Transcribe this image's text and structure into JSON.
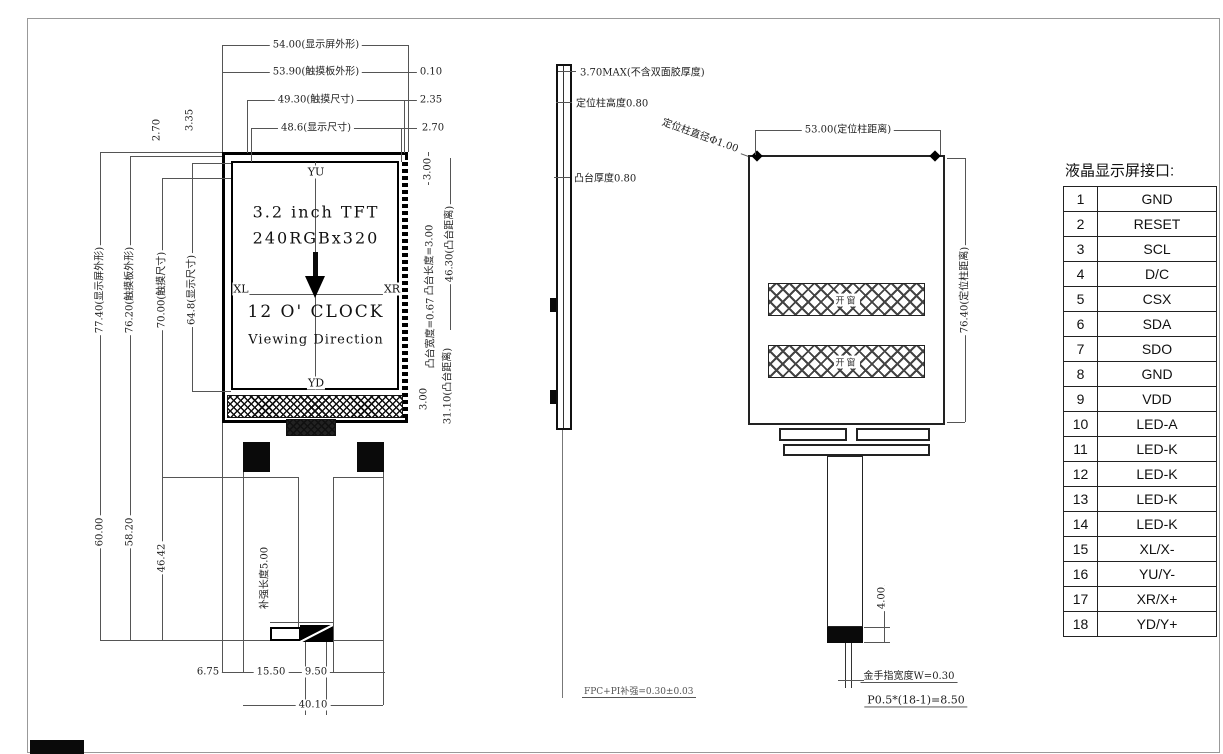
{
  "front_view": {
    "size_label_1": "3.2 inch TFT",
    "size_label_2": "240RGBx320",
    "clock": "12 O' CLOCK",
    "viewing": "Viewing Direction",
    "marker_top": "YU",
    "marker_bottom": "YD",
    "marker_left": "XL",
    "marker_right": "XR",
    "dim_top_1": "54.00(显示屏外形)",
    "dim_top_2": "53.90(触摸板外形)",
    "dim_top_3": "49.30(触摸尺寸)",
    "dim_top_4": "48.6(显示尺寸)",
    "dim_top_right_1": "0.10",
    "dim_top_right_2": "2.35",
    "dim_top_right_3": "2.70",
    "dim_left_1": "77.40(显示屏外形)",
    "dim_left_2": "76.20(触摸板外形)",
    "dim_left_3": "70.00(触摸尺寸)",
    "dim_left_4": "64.8(显示尺寸)",
    "dim_left_small_1": "2.70",
    "dim_left_small_2": "3.35",
    "dim_right_1": "3.00",
    "dim_right_2": "凸台长度=3.00",
    "dim_right_3": "46.30(凸台距离)",
    "dim_right_4": "凸台宽度=0.67",
    "dim_right_5": "3.00",
    "dim_right_6": "31.10(凸台距离)",
    "dim_bottom_left_1": "60.00",
    "dim_bottom_left_2": "58.20",
    "dim_bottom_left_3": "46.42",
    "stiffener": "补强长度5.00",
    "dim_bottom_1": "6.75",
    "dim_bottom_2": "15.50",
    "dim_bottom_3": "9.50",
    "dim_bottom_4": "40.10"
  },
  "side_view": {
    "label_thickness": "3.70MAX(不含双面胶厚度)",
    "label_post_height": "定位柱高度0.80",
    "label_boss_thickness": "凸台厚度0.80",
    "label_post_diameter": "定位柱直径Φ1.00",
    "label_fpc": "FPC+PI补强=0.30±0.03"
  },
  "back_view": {
    "dim_top": "53.00(定位柱距离)",
    "dim_right": "76.40(定位柱距离)",
    "window": "开窗",
    "dim_tail": "4.00",
    "note_finger": "金手指宽度W=0.30",
    "note_pitch": "P0.5*(18-1)=8.50"
  },
  "pin_table": {
    "title": "液晶显示屏接口:",
    "rows": [
      {
        "no": "1",
        "name": "GND"
      },
      {
        "no": "2",
        "name": "RESET"
      },
      {
        "no": "3",
        "name": "SCL"
      },
      {
        "no": "4",
        "name": "D/C"
      },
      {
        "no": "5",
        "name": "CSX"
      },
      {
        "no": "6",
        "name": "SDA"
      },
      {
        "no": "7",
        "name": "SDO"
      },
      {
        "no": "8",
        "name": "GND"
      },
      {
        "no": "9",
        "name": "VDD"
      },
      {
        "no": "10",
        "name": "LED-A"
      },
      {
        "no": "11",
        "name": "LED-K"
      },
      {
        "no": "12",
        "name": "LED-K"
      },
      {
        "no": "13",
        "name": "LED-K"
      },
      {
        "no": "14",
        "name": "LED-K"
      },
      {
        "no": "15",
        "name": "XL/X-"
      },
      {
        "no": "16",
        "name": "YU/Y-"
      },
      {
        "no": "17",
        "name": "XR/X+"
      },
      {
        "no": "18",
        "name": "YD/Y+"
      }
    ]
  },
  "colors": {
    "line": "#111111",
    "dim": "#555555"
  }
}
